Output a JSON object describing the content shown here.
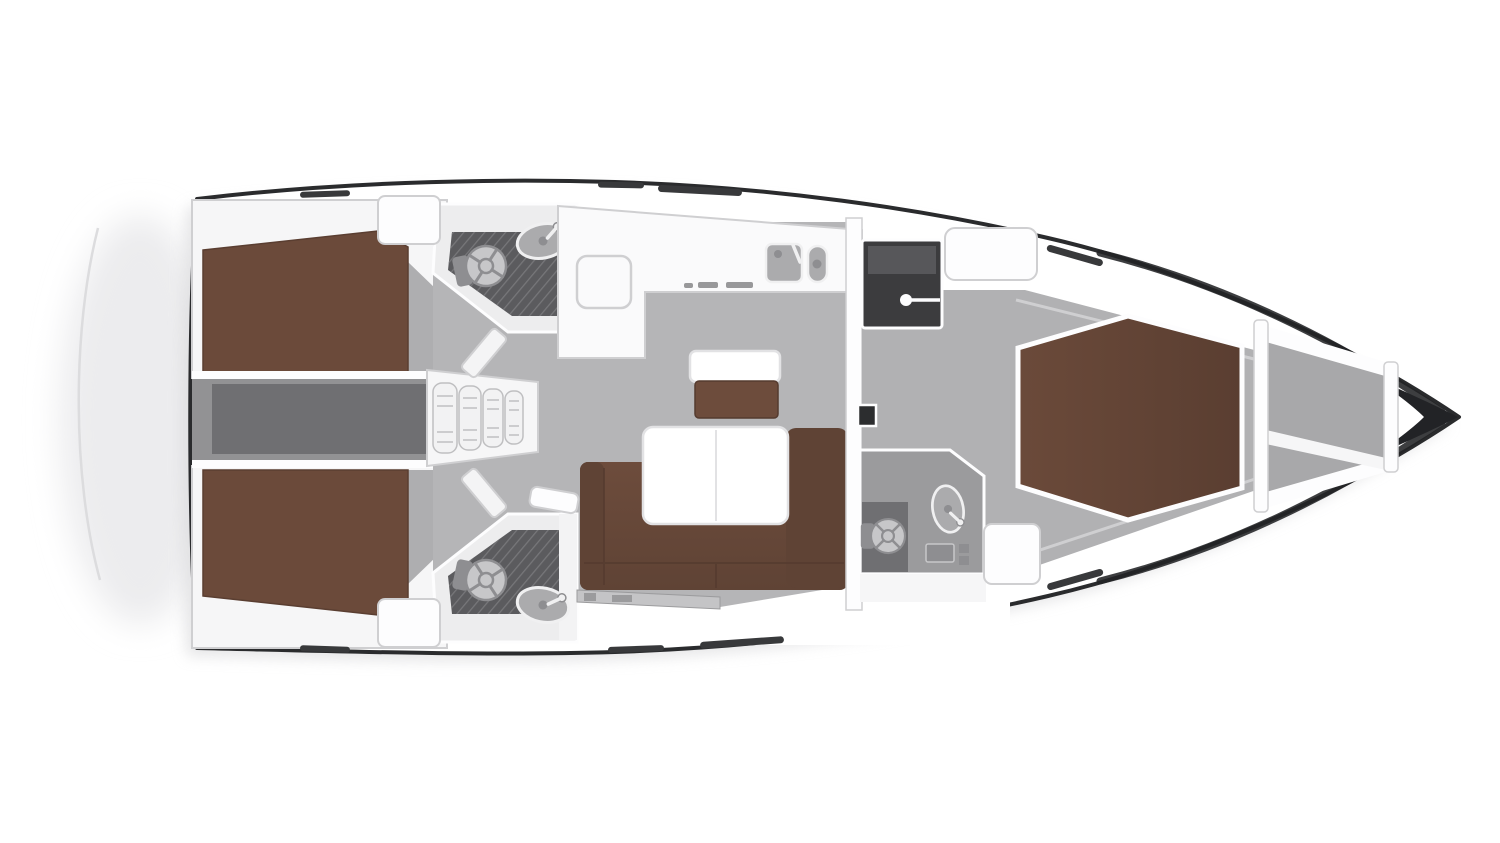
{
  "meta": {
    "alt": "Top-down interior layout plan of a sailing yacht: two aft double cabins, two aft heads, saloon with L-sofa and table, L-shaped galley, forward owner cabin with island berth, en-suite forward head, anchor locker in the bow"
  },
  "colors": {
    "page_bg": "#ffffff",
    "halo": "#ececee",
    "shadow": "#d9d9db",
    "transom_line": "#dcdcde",
    "hull_fill": "#ffffff",
    "hull_line": "#2a2b2d",
    "bow_dark": "#222326",
    "wall": "#f6f6f7",
    "wall_bright": "#fdfdfe",
    "wall_stroke": "#cfcfd1",
    "floor": "#b5b5b7",
    "floor_fwd": "#b1b1b3",
    "floor_strip": "#aeaeb0",
    "corridor": "#929294",
    "corridor_dark": "#6f6f72",
    "berth": "#6b4a3a",
    "berth_dark": "#5a3e31",
    "sofa": "#6d4c3c",
    "sofa_dark": "#5f4335",
    "seam": "#553b2f",
    "table": "#ffffff",
    "table_stroke": "#e2e2e4",
    "head_room": "#ededee",
    "head_floor": "#9b9b9d",
    "shower": "#5b5b5e",
    "vanity": "#f3f3f4",
    "fixture": "#c7c7c9",
    "fixture_dark": "#8e8e91",
    "sink": "#ababad",
    "sink_rim": "#f0f0f1",
    "wardrobe": "#3c3c3e",
    "wardrobe_top": "#57575a",
    "anchor": "#a8a8aa",
    "slit": "#38393b",
    "locker_strip": "#c4c4c6",
    "locker_mark": "#9b9b9d",
    "tv": "#2c2d2f",
    "steps": "#f2f2f3",
    "steps_stroke": "#bfbfc1",
    "galley": "#fafafb",
    "stove": "#98989a",
    "door": "#f4f4f5"
  }
}
